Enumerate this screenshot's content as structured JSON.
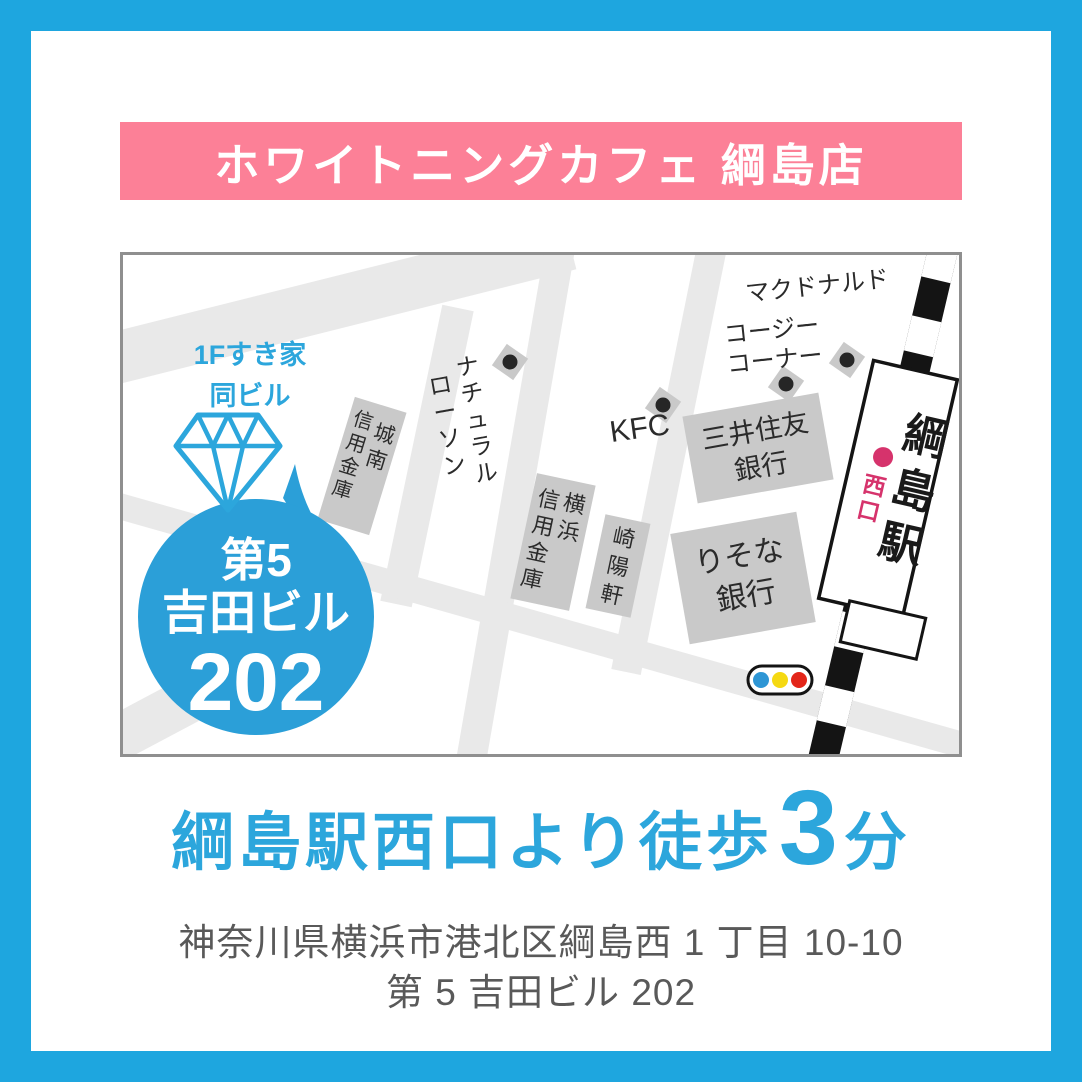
{
  "header": {
    "title": "ホワイトニングカフェ 綱島店"
  },
  "colors": {
    "frame_cyan": "#1ea6df",
    "banner_pink": "#fc8097",
    "accent_blue": "#2ca6dc",
    "balloon_blue": "#2b9fd8",
    "road_gray": "#e9e9e9",
    "building_gray": "#c9c9c9",
    "station_pink": "#d6336c",
    "signal_blue": "#2e96d5",
    "signal_yellow": "#f5d912",
    "signal_red": "#e3261a"
  },
  "map": {
    "landmarks": {
      "mcdonalds": "マクドナルド",
      "cozy_corner": {
        "lines": [
          "コージー",
          "コーナー"
        ]
      },
      "kfc": "KFC",
      "natural_lawson": {
        "cols": [
          "ナチュラル",
          "ローソン"
        ]
      },
      "sumitomo_mitsui": {
        "lines": [
          "三井住友",
          "銀行"
        ]
      },
      "resona": {
        "lines": [
          "りそな",
          "銀行"
        ]
      },
      "yokohama_shinkin": {
        "cols": [
          "横浜",
          "信用金庫"
        ]
      },
      "kiyoken": "崎陽軒",
      "jonan_shinkin": {
        "cols": [
          "城南",
          "信用金庫"
        ]
      },
      "station": {
        "name": "綱島駅",
        "exit": "西口"
      }
    },
    "callout": {
      "note": {
        "line1": "1Fすき家",
        "line2": "同ビル"
      },
      "bubble": {
        "line1": "第5",
        "line2": "吉田ビル",
        "line3": "202"
      }
    },
    "icons": {
      "poi_dot": "poi-dot-icon",
      "diamond": "diamond-gem-icon",
      "traffic_light": "traffic-light-icon"
    }
  },
  "footer": {
    "walk": {
      "prefix": "綱島駅西口より徒歩",
      "number": "3",
      "suffix": "分"
    },
    "address": {
      "line1": "神奈川県横浜市港北区綱島西 1 丁目 10-10",
      "line2": "第 5 吉田ビル 202"
    }
  }
}
